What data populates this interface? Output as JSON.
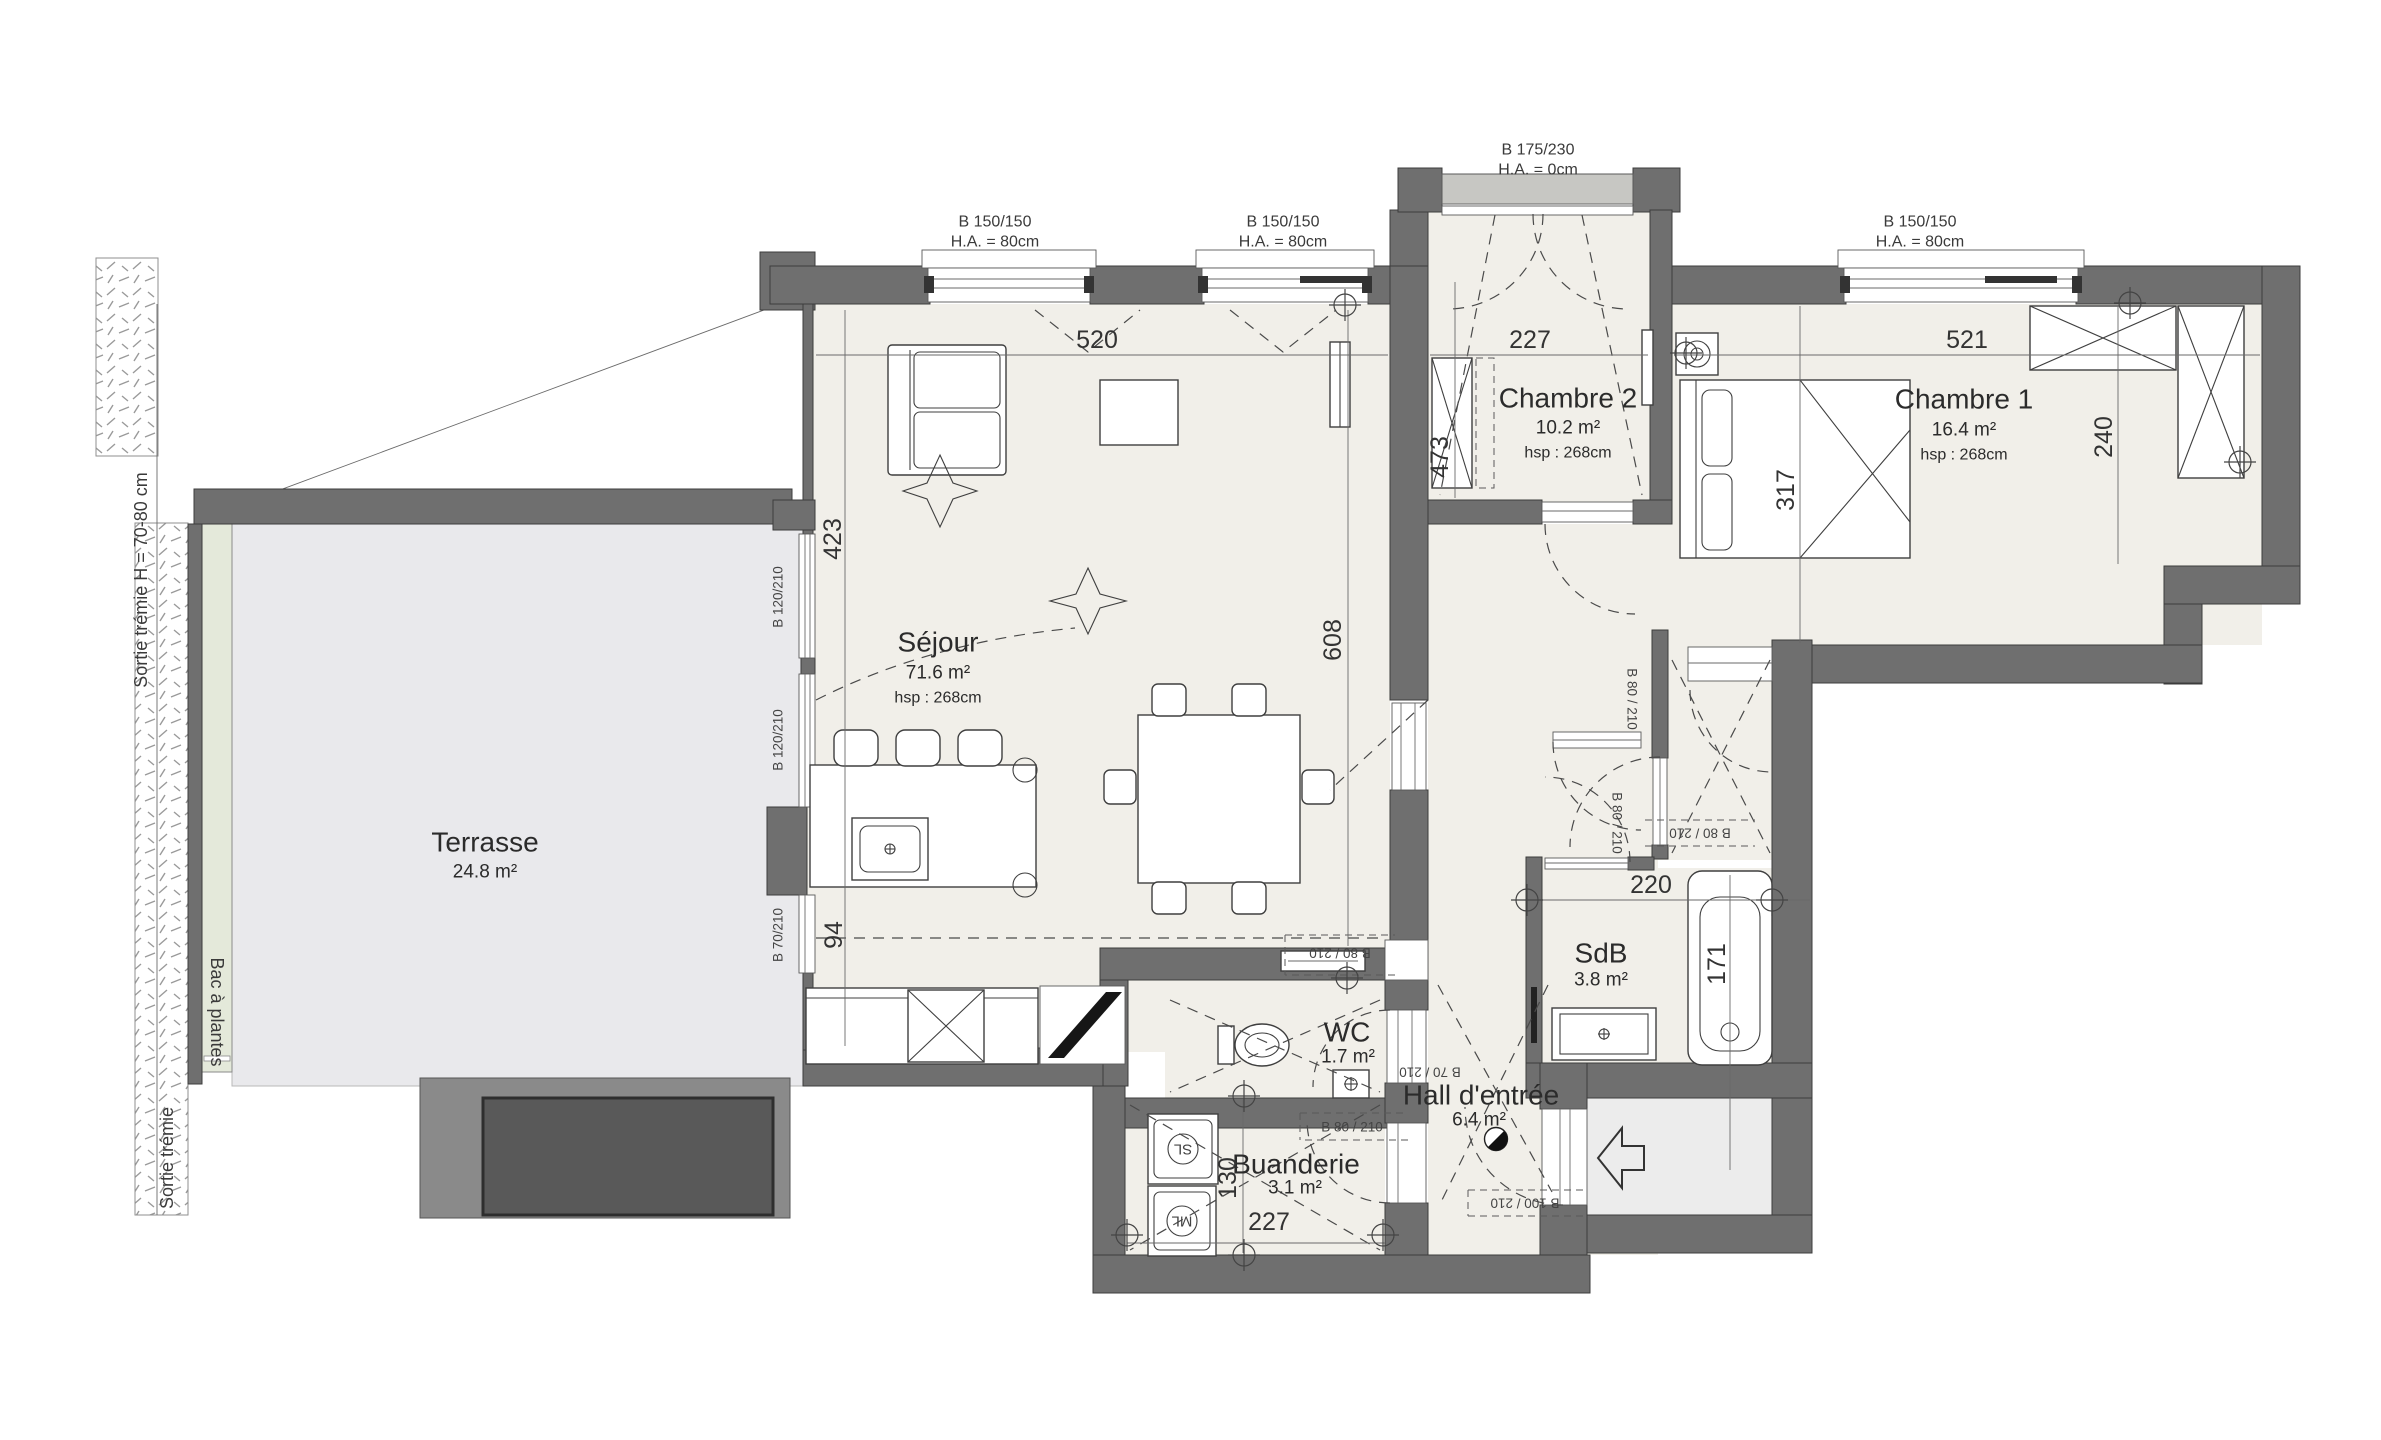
{
  "plan": {
    "rooms": [
      {
        "name": "Séjour",
        "area": "71.6 m²",
        "hsp": "hsp : 268cm"
      },
      {
        "name": "Chambre 2",
        "area": "10.2 m²",
        "hsp": "hsp : 268cm"
      },
      {
        "name": "Chambre 1",
        "area": "16.4 m²",
        "hsp": "hsp : 268cm"
      },
      {
        "name": "Terrasse",
        "area": "24.8 m²",
        "hsp": ""
      },
      {
        "name": "SdB",
        "area": "3.8 m²",
        "hsp": ""
      },
      {
        "name": "WC",
        "area": "1.7 m²",
        "hsp": ""
      },
      {
        "name": "Hall d'entrée",
        "area": "6.4 m²",
        "hsp": ""
      },
      {
        "name": "Buanderie",
        "area": "3.1 m²",
        "hsp": ""
      }
    ],
    "windows": [
      {
        "size": "B 150/150",
        "ha": "H.A. = 80cm"
      },
      {
        "size": "B 150/150",
        "ha": "H.A. = 80cm"
      },
      {
        "size": "B 175/230",
        "ha": "H.A. = 0cm"
      },
      {
        "size": "B 150/150",
        "ha": "H.A. = 80cm"
      }
    ],
    "door_labels": {
      "terrace_upper": "B 120/210",
      "terrace_lower": "B 120/210",
      "terrace_small": "B 70/210",
      "sejour_hall": "B 80 / 210",
      "wc": "B 70 / 210",
      "buanderie": "B 80 / 210",
      "entrance": "B 100 / 210",
      "corridor_a": "B 80 / 210",
      "corridor_b": "B 80 / 210",
      "corridor_c": "B 80 / 210"
    },
    "dimensions": {
      "sejour_width": "520",
      "chambre2_width": "227",
      "chambre1_width": "521",
      "sejour_left_upper": "423",
      "sejour_left_lower": "94",
      "sejour_height": "608",
      "chambre2_height": "473",
      "chambre1_depth": "317",
      "chambre1_right": "240",
      "sdb_width": "220",
      "bathtub_length": "171",
      "buanderie_height": "130",
      "buanderie_width": "227"
    },
    "annotations": {
      "tremie_note": "Sortie trémie H = 70-80 cm",
      "planter": "Bac à plantes",
      "tremie": "Sortie trémie"
    },
    "appliances": {
      "dryer": "SL",
      "washer": "ML"
    }
  },
  "colors": {
    "wall": "#6f6f6f",
    "floor": "#f1efe9",
    "terrace": "#e9e9ec",
    "planter": "#e4e9da",
    "patio_dark": "#595959",
    "line": "#3f3f3f"
  }
}
